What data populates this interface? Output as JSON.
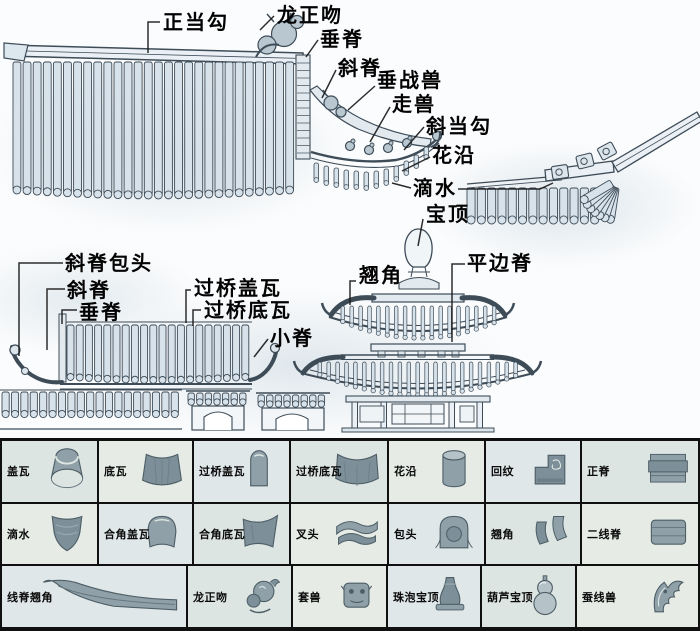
{
  "callouts": {
    "zhengdanggou": "正当勾",
    "longzhengwen": "龙正吻",
    "chuiji_top": "垂脊",
    "xieji_top": "斜脊",
    "chuizhanshou": "垂战兽",
    "zoushou": "走兽",
    "xiedanggou": "斜当勾",
    "huayan": "花沿",
    "dishui": "滴水",
    "baoding": "宝顶",
    "pingbianji": "平边脊",
    "qiaojiao": "翘角",
    "xiejibaotou": "斜脊包头",
    "xieji_mid": "斜脊",
    "chuiji_mid": "垂脊",
    "guoqiaogaiwa": "过桥盖瓦",
    "guoqiaodiwa": "过桥底瓦",
    "xiaoji": "小脊"
  },
  "table": {
    "rows": [
      {
        "cells": [
          {
            "label": "盖瓦",
            "icon": "cap-tile"
          },
          {
            "label": "底瓦",
            "icon": "pan-tile"
          },
          {
            "label": "过桥盖瓦",
            "icon": "bridge-cap-tile"
          },
          {
            "label": "过桥底瓦",
            "icon": "bridge-pan-tile"
          },
          {
            "label": "花沿",
            "icon": "flower-edge-tile"
          },
          {
            "label": "回纹",
            "icon": "fret-scroll-block"
          },
          {
            "label": "正脊",
            "icon": "main-ridge-block"
          }
        ]
      },
      {
        "cells": [
          {
            "label": "滴水",
            "icon": "drip-tile"
          },
          {
            "label": "合角盖瓦",
            "icon": "corner-cap-tile"
          },
          {
            "label": "合角底瓦",
            "icon": "corner-pan-tile"
          },
          {
            "label": "叉头",
            "icon": "fork-head-block"
          },
          {
            "label": "包头",
            "icon": "wrap-head-block"
          },
          {
            "label": "翘角",
            "icon": "upturned-corner-tile"
          },
          {
            "label": "二线脊",
            "icon": "double-line-ridge"
          }
        ]
      },
      {
        "cells": [
          {
            "label": "线脊翘角",
            "icon": "line-ridge-corner",
            "wide": true
          },
          {
            "label": "龙正吻",
            "icon": "dragon-kiss-ornament"
          },
          {
            "label": "套兽",
            "icon": "sleeve-beast-head"
          },
          {
            "label": "珠泡宝顶",
            "icon": "pearl-finial"
          },
          {
            "label": "葫芦宝顶",
            "icon": "gourd-finial"
          },
          {
            "label": "蚕线兽",
            "icon": "silk-line-beast"
          }
        ]
      }
    ]
  },
  "colors": {
    "line": "#3e4c58",
    "tile_fill": "#d7e2ea",
    "ornament_fill": "#b9c7d1",
    "table_cell_bg": "#e2e8e4",
    "border_black": "#111111",
    "part_gray": "#8fa0a8"
  }
}
